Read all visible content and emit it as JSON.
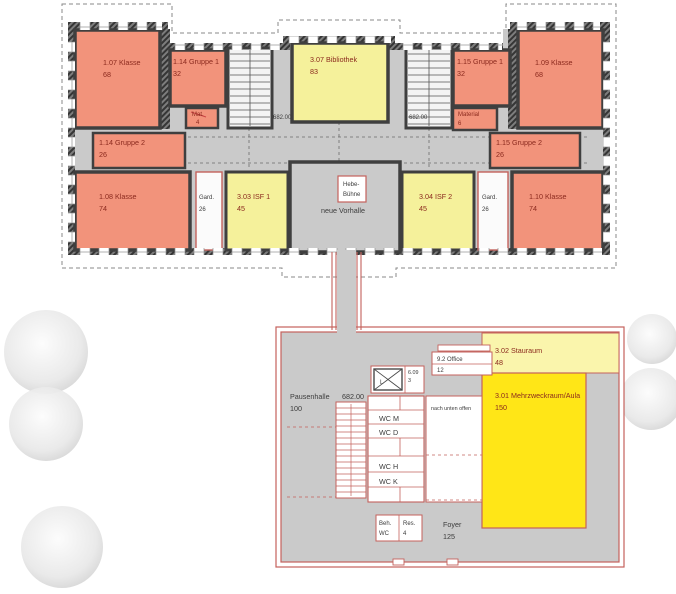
{
  "plan": {
    "upper": {
      "k107": {
        "name": "1.07 Klasse",
        "area": "68"
      },
      "g114_1": {
        "name": "1.14 Gruppe 1",
        "area": "32"
      },
      "mat": {
        "name": "Mat.",
        "area": "4"
      },
      "biblio": {
        "name": "3.07 Bibliothek",
        "area": "83"
      },
      "g115_1": {
        "name": "1.15 Gruppe 1",
        "area": "32"
      },
      "material": {
        "name": "Material",
        "area": "6"
      },
      "k109": {
        "name": "1.09 Klasse",
        "area": "68"
      },
      "g114_2": {
        "name": "1.14 Gruppe 2",
        "area": "26"
      },
      "g115_2": {
        "name": "1.15 Gruppe 2",
        "area": "26"
      },
      "k108": {
        "name": "1.08 Klasse",
        "area": "74"
      },
      "gard_w": {
        "name": "Gard.",
        "area": "26"
      },
      "isf1": {
        "name": "3.03 ISF 1",
        "area": "45"
      },
      "vorhalle": {
        "name": "neue Vorhalle"
      },
      "hebe": {
        "line1": "Hebe-",
        "line2": "Bühne"
      },
      "isf2": {
        "name": "3.04 ISF 2",
        "area": "45"
      },
      "gard_e": {
        "name": "Gard.",
        "area": "26"
      },
      "k110": {
        "name": "1.10 Klasse",
        "area": "74"
      },
      "level_left": "682.00",
      "level_right": "682.00"
    },
    "lower": {
      "pausenhalle": {
        "name": "Pausenhalle",
        "area": "100",
        "level": "682.00"
      },
      "lift": {
        "label": "L"
      },
      "r609": {
        "name": "6.09",
        "area": "3"
      },
      "office": {
        "name": "9.2 Office",
        "area": "12"
      },
      "stauraum": {
        "name": "3.02 Stauraum",
        "area": "48"
      },
      "aula": {
        "name": "3.01 Mehrzweckraum/Aula",
        "area": "150"
      },
      "void_note": "nach unten offen",
      "wc_m": "WC M",
      "wc_d": "WC D",
      "wc_h": "WC H",
      "wc_k": "WC K",
      "beh_wc": {
        "line1": "Beh.",
        "line2": "WC"
      },
      "res": {
        "name": "Res.",
        "area": "4"
      },
      "foyer": {
        "name": "Foyer",
        "area": "125"
      }
    },
    "colors": {
      "classroom_orange": "#F2937B",
      "special_room_yellow": "#F5F19B",
      "stauraum_light_yellow": "#FAF5AC",
      "aula_bright_yellow": "#FFE617",
      "circulation_gray": "#CACACA",
      "existing_wall_dark": "#4A4A4A",
      "new_construction_red": "#C4625C",
      "room_label_red": "#8B2A1E",
      "annotation_dark": "#3C3C3C"
    }
  }
}
